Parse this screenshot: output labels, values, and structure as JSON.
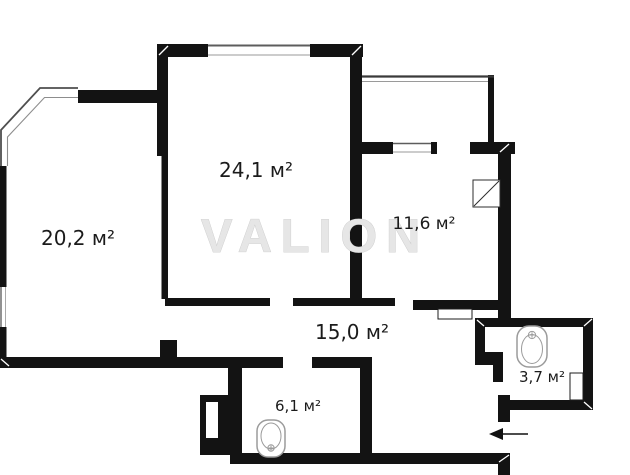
{
  "watermark": {
    "text": "VALION"
  },
  "rooms": {
    "room_24": {
      "label": "24,1 м²"
    },
    "room_20": {
      "label": "20,2 м²"
    },
    "room_11": {
      "label": "11,6 м²"
    },
    "hall_15": {
      "label": "15,0 м²"
    },
    "room_6": {
      "label": "6,1 м²"
    },
    "bath_3": {
      "label": "3,7 м²"
    }
  },
  "icons": {
    "bathtub": "bathtub-icon",
    "toilet": "toilet-icon",
    "vent_shaft": "vent-shaft-icon",
    "entrance_arrow": "entrance-arrow-icon"
  },
  "colors": {
    "background": "#ffffff",
    "wall": "#131313",
    "label": "#1b1b1b",
    "watermark": "#e6e6e6",
    "fixture_outline": "#9b9b9b",
    "window_line": "#8a8a8a"
  }
}
